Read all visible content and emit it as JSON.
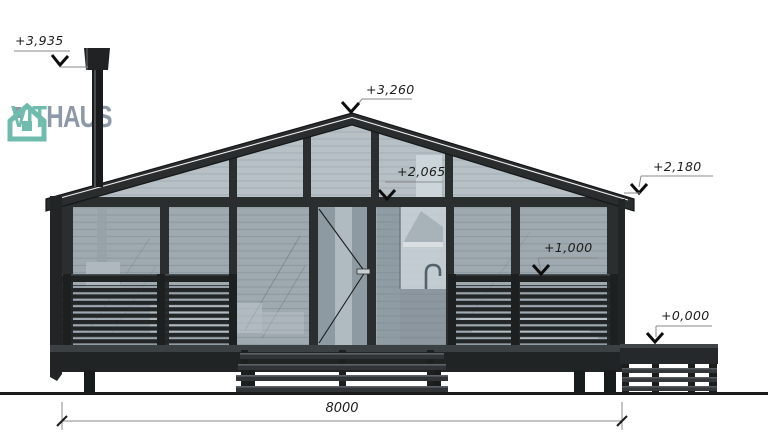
{
  "brand": {
    "primary": "VIT",
    "secondary": "HAUS",
    "icon": "house-logo-icon",
    "teal": "#6fbcae",
    "gray": "#8d99a6"
  },
  "levels": {
    "chimney_top": {
      "label": "+3,935"
    },
    "ridge": {
      "label": "+3,260"
    },
    "eave_right": {
      "label": "+2,180"
    },
    "door_head": {
      "label": "+2,065"
    },
    "railing_top": {
      "label": "+1,000"
    },
    "entry_platform": {
      "label": "+0,000"
    }
  },
  "dimension": {
    "overall_width": {
      "label": "8000"
    }
  },
  "icons": {
    "logo": "house-logo-icon",
    "level_marker": "check-arrow-icon"
  },
  "colors": {
    "frame": "#2b2e2f",
    "glass": "#9fa9b0",
    "glass_gable": "#b6c0c5",
    "ground": "#1b1b1b",
    "annotation_ink": "#1c1c1c"
  }
}
